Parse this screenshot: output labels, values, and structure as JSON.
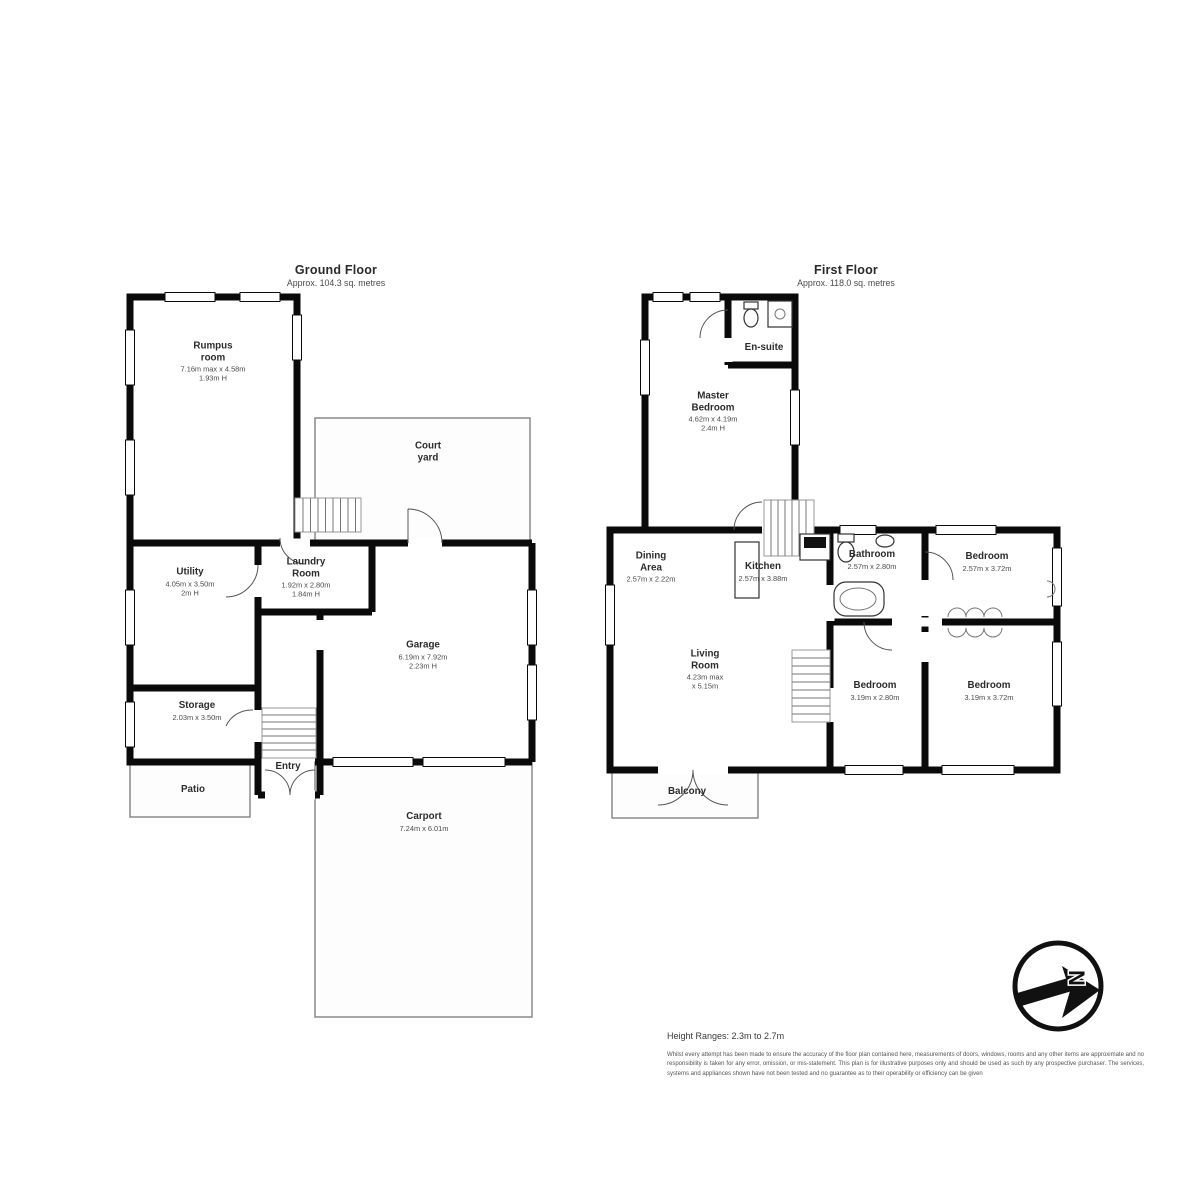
{
  "ground": {
    "title": "Ground Floor",
    "subtitle": "Approx. 104.3 sq. metres",
    "rooms": {
      "rumpus": {
        "name": "Rumpus\nroom",
        "dims": "7.16m max x 4.58m",
        "height": "1.93m H"
      },
      "court": {
        "name": "Court\nyard"
      },
      "laundry": {
        "name": "Laundry\nRoom",
        "dims": "1.92m x 2.80m",
        "height": "1.84m H"
      },
      "utility": {
        "name": "Utility",
        "dims": "4.05m x 3.50m",
        "height": "2m H"
      },
      "garage": {
        "name": "Garage",
        "dims": "6.19m x 7.92m",
        "height": "2.23m H"
      },
      "storage": {
        "name": "Storage",
        "dims": "2.03m x 3.50m"
      },
      "entry": {
        "name": "Entry"
      },
      "patio": {
        "name": "Patio"
      },
      "carport": {
        "name": "Carport",
        "dims": "7.24m x 6.01m"
      }
    }
  },
  "first": {
    "title": "First Floor",
    "subtitle": "Approx. 118.0 sq. metres",
    "rooms": {
      "ensuite": {
        "name": "En-suite"
      },
      "master": {
        "name": "Master\nBedroom",
        "dims": "4.62m x 4.19m",
        "height": "2.4m H"
      },
      "dining": {
        "name": "Dining\nArea",
        "dims": "2.57m x 2.22m"
      },
      "kitchen": {
        "name": "Kitchen",
        "dims": "2.57m x 3.88m"
      },
      "bathroom": {
        "name": "Bathroom",
        "dims": "2.57m x 2.80m"
      },
      "bedroom_top": {
        "name": "Bedroom",
        "dims": "2.57m x 3.72m"
      },
      "living": {
        "name": "Living\nRoom",
        "dims": "4.23m max\nx 5.15m"
      },
      "bedroom_mid": {
        "name": "Bedroom",
        "dims": "3.19m x 2.80m"
      },
      "bedroom_right": {
        "name": "Bedroom",
        "dims": "3.19m x 3.72m"
      },
      "balcony": {
        "name": "Balcony"
      }
    }
  },
  "footer": {
    "height_ranges": "Height Ranges: 2.3m to 2.7m",
    "disclaimer": "Whilst every attempt has been made to ensure the accuracy of the floor plan contained here, measurements of doors, windows, rooms and any other items are approximate and no responsibility is taken for any error, omission, or mis-statement. This plan is for illustrative purposes only and should be used as such by any prospective purchaser. The services, systems and appliances shown have not been tested and no guarantee as to their operability or efficiency can be given"
  },
  "compass": {
    "letter": "N"
  },
  "colors": {
    "wall": "#0a0a0a",
    "thin_outline": "#8a8a8a",
    "text": "#2c2c2c"
  }
}
